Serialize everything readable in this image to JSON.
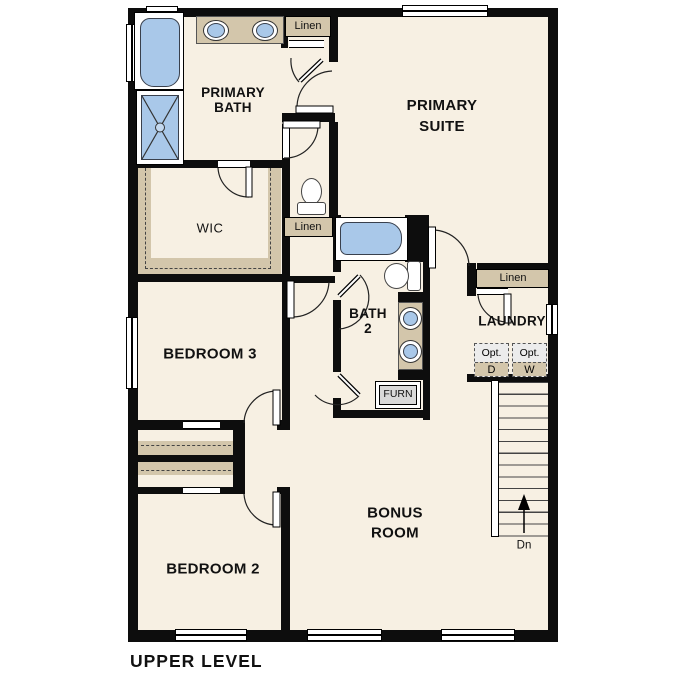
{
  "title": "UPPER LEVEL",
  "colors": {
    "floor": "#f7f0e3",
    "tan": "#d3c6ab",
    "fixture_blue": "#a9c8e9",
    "wall": "#0d0d0d"
  },
  "rooms": {
    "primary_bath": {
      "lines": [
        "PRIMARY",
        "BATH"
      ]
    },
    "primary_suite": {
      "lines": [
        "PRIMARY",
        "SUITE"
      ]
    },
    "wic": {
      "label": "WIC"
    },
    "bedroom3": {
      "label": "BEDROOM 3"
    },
    "bath2": {
      "lines": [
        "BATH",
        "2"
      ]
    },
    "laundry": {
      "label": "LAUNDRY"
    },
    "bedroom2": {
      "label": "BEDROOM 2"
    },
    "bonus": {
      "lines": [
        "BONUS",
        "ROOM"
      ]
    }
  },
  "closets": {
    "linen_top": "Linen",
    "linen_mid": "Linen",
    "linen_laundry": "Linen"
  },
  "labels": {
    "furnace": "FURN",
    "stairs_down": "Dn"
  },
  "appliances": {
    "dryer": {
      "prefix": "Opt.",
      "letter": "D"
    },
    "washer": {
      "prefix": "Opt.",
      "letter": "W"
    }
  }
}
